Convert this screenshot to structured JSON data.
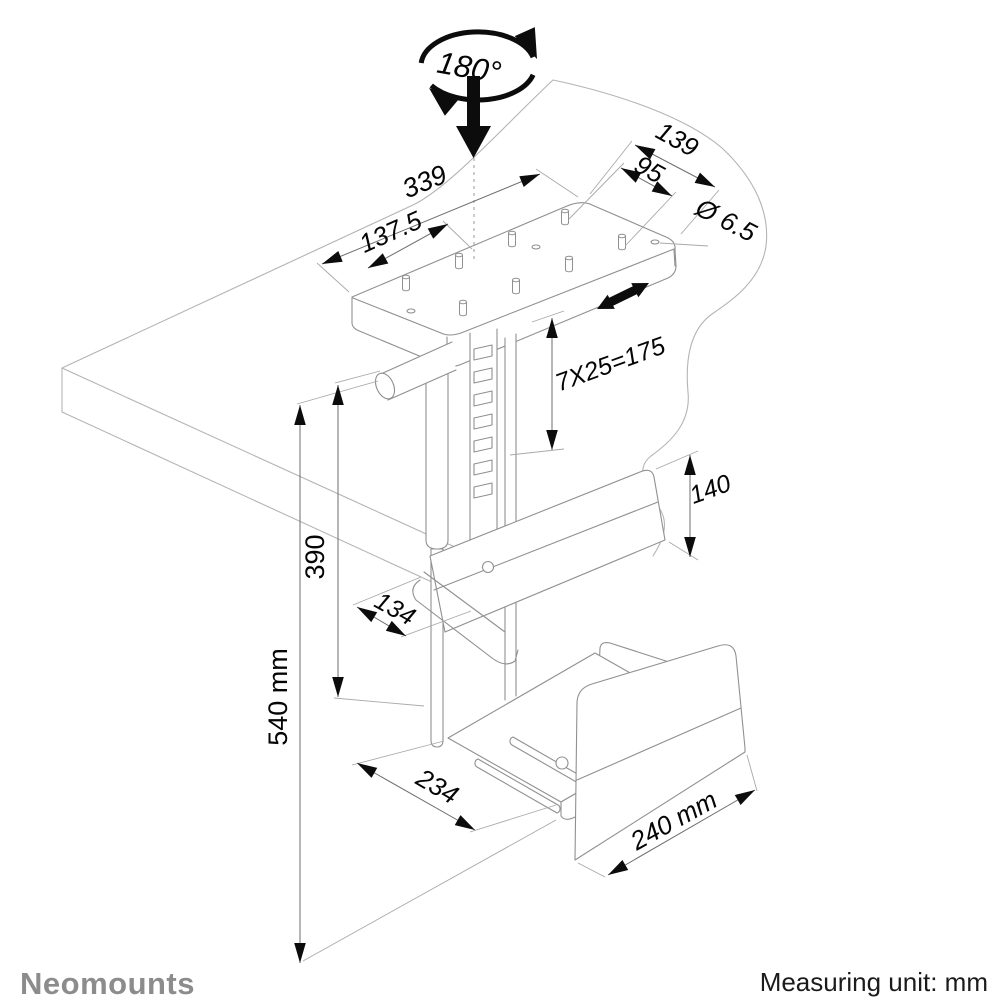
{
  "diagram": {
    "rotation_label": "180°",
    "dimensions": {
      "plate_length": "339",
      "plate_half_length": "137.5",
      "plate_width": "139",
      "hole_spacing": "95",
      "hole_diameter": "Ø 6.5",
      "slot_pattern": "7X25=175",
      "clamp_panel_height": "140",
      "column_travel": "390",
      "clamp_depth": "134",
      "total_height": "540 mm",
      "tray_depth": "234",
      "tray_width": "240 mm"
    },
    "footer": {
      "brand": "Neomounts",
      "measuring_note": "Measuring unit: mm"
    },
    "colors": {
      "line_black": "#0c0c0c",
      "structure_gray": "#909090",
      "desk_gray": "#b4b4b4",
      "brand_gray": "#8c8c8c"
    }
  }
}
